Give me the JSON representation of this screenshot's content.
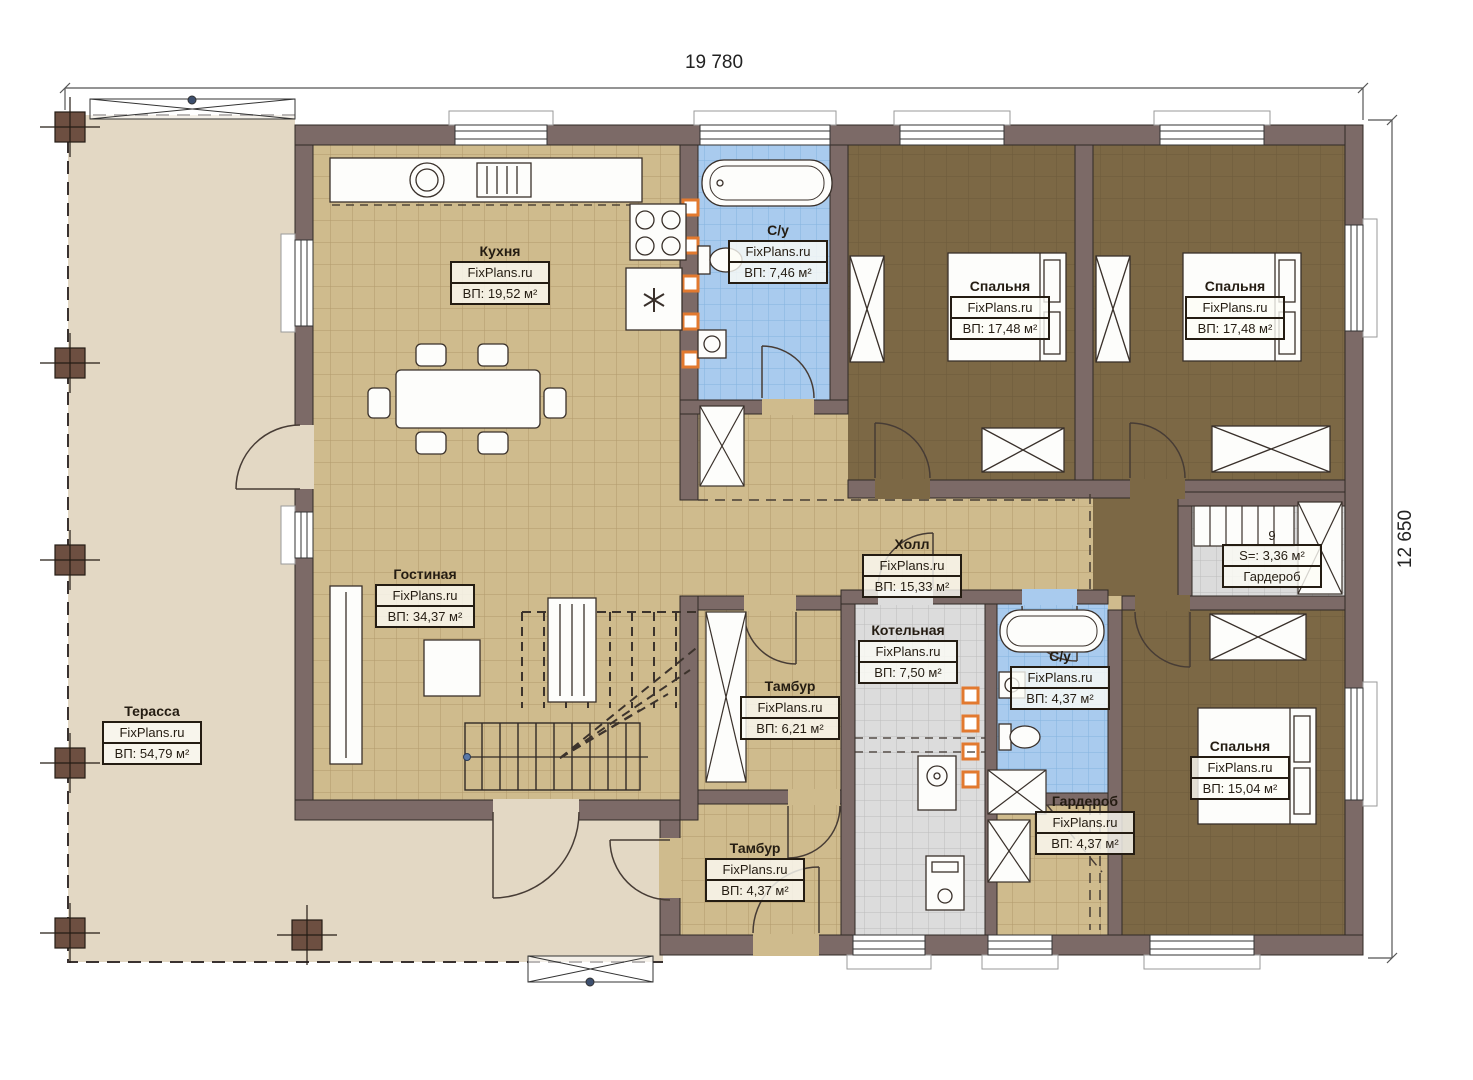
{
  "meta": {
    "plan_width_label": "19 780",
    "plan_height_label": "12 650",
    "watermark": "FixPlans.ru"
  },
  "colors": {
    "wall": "#7c6a67",
    "wood_floor": "#cfbb8d",
    "bedroom_floor": "#7c6845",
    "bathroom_floor": "#a9cbee",
    "utility_floor": "#dbdbdb",
    "terrace_floor": "#e3d8c4",
    "radiator_accent": "#e2792f",
    "label_border": "#241c12"
  },
  "rooms": [
    {
      "name": "Кухня",
      "area": "ВП: 19,52 м²"
    },
    {
      "name": "С/у",
      "area": "ВП: 7,46 м²"
    },
    {
      "name": "Спальня",
      "area": "ВП: 17,48 м²"
    },
    {
      "name": "Спальня",
      "area": "ВП: 17,48 м²"
    },
    {
      "name": "Холл",
      "area": "ВП: 15,33 м²"
    },
    {
      "name": "Гостиная",
      "area": "ВП: 34,37 м²"
    },
    {
      "name": "Терасса",
      "area": "ВП: 54,79 м²"
    },
    {
      "name": "Тамбур",
      "area": "ВП: 6,21 м²"
    },
    {
      "name": "Котельная",
      "area": "ВП: 7,50 м²"
    },
    {
      "name": "С/у",
      "area": "ВП: 4,37 м²"
    },
    {
      "name": "Спальня",
      "area": "ВП: 15,04 м²"
    },
    {
      "name": "Тамбур",
      "area": "ВП: 4,37 м²"
    },
    {
      "name": "Гардероб",
      "area": "ВП: 4,37 м²"
    }
  ],
  "wardrobe_right": {
    "number": "9",
    "area": "S=: 3,36 м²",
    "name": "Гардероб"
  }
}
